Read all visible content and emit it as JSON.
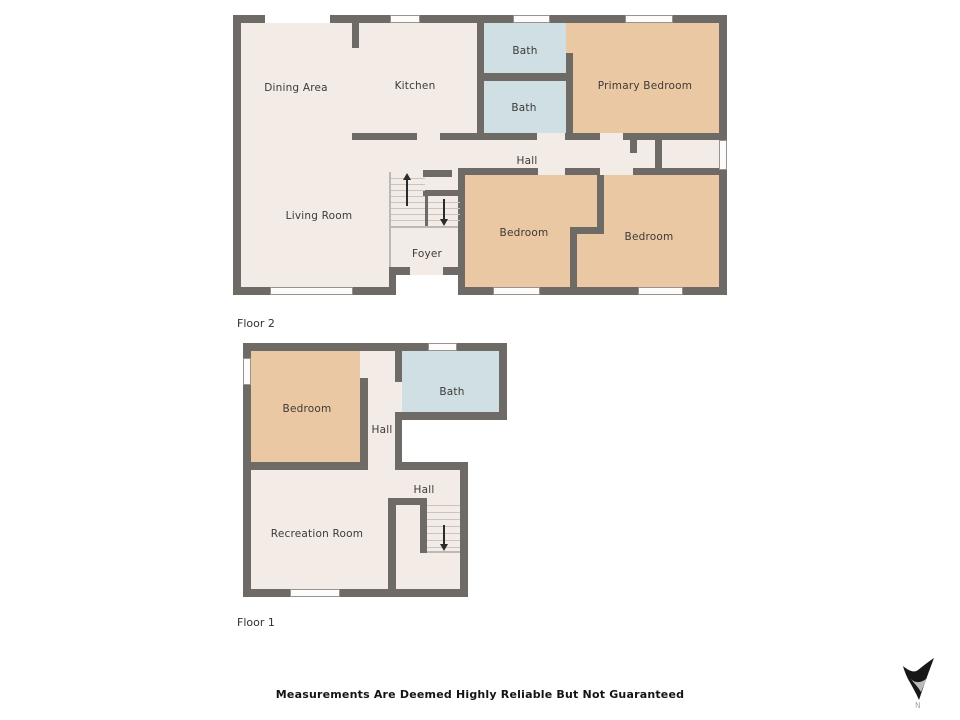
{
  "floor2": {
    "name": "Floor 2",
    "rooms": {
      "dining_area": "Dining Area",
      "kitchen": "Kitchen",
      "bath_upper": "Bath",
      "bath_lower": "Bath",
      "primary_bedroom": "Primary Bedroom",
      "hall": "Hall",
      "living_room": "Living Room",
      "foyer": "Foyer",
      "bedroom_left": "Bedroom",
      "bedroom_right": "Bedroom"
    }
  },
  "floor1": {
    "name": "Floor 1",
    "rooms": {
      "bedroom": "Bedroom",
      "bath": "Bath",
      "hall_upper": "Hall",
      "hall_lower": "Hall",
      "recreation_room": "Recreation Room"
    }
  },
  "footer": {
    "disclaimer": "Measurements Are Deemed Highly Reliable But Not Guaranteed"
  },
  "compass": {
    "north_label": "N"
  },
  "colors": {
    "wall": "#6e6a66",
    "floor": "#f3ece6",
    "bedroom_fill": "#ebc8a4",
    "bath_fill": "#cfdfe3",
    "background": "#ffffff"
  }
}
